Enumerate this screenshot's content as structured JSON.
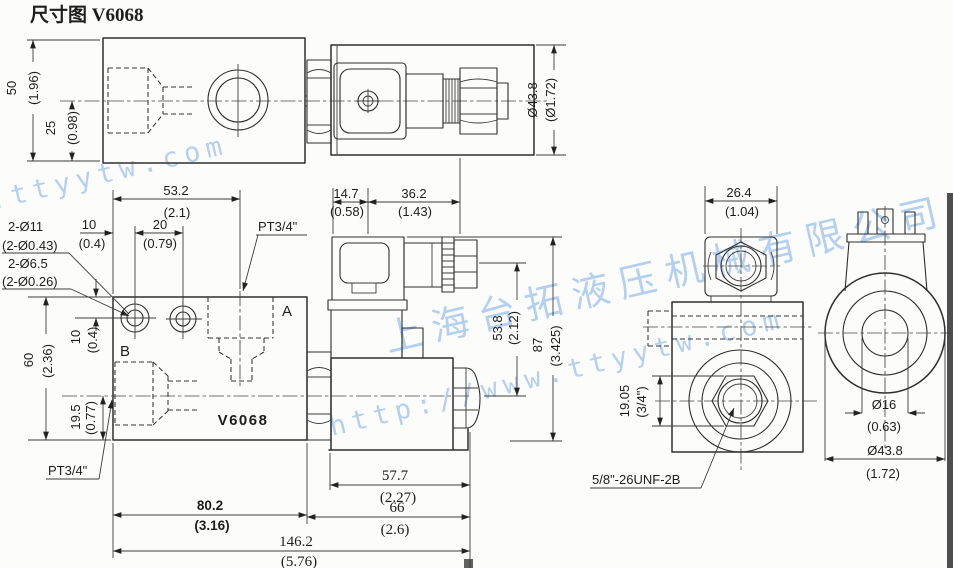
{
  "title": "尺寸图 V6068",
  "watermark": {
    "company": "上海台拓液压机械有限公司",
    "url": "http://www.ttyytw.com",
    "color": "#9fc4ee"
  },
  "labels": {
    "port_a": "A",
    "port_b": "B",
    "model": "V6068",
    "port_thread_top": "PT3/4\"",
    "port_thread_bottom": "PT3/4\"",
    "mount_holes_outer_mm": "2-Ø11",
    "mount_holes_outer_in": "(2-Ø0.43)",
    "mount_holes_inner_mm": "2-Ø6.5",
    "mount_holes_inner_in": "(2-Ø0.26)",
    "cartridge_thread": "5/8\"-26UNF-2B"
  },
  "dims": {
    "h50": {
      "mm": "50",
      "in": "(1.96)"
    },
    "h25": {
      "mm": "25",
      "in": "(0.98)"
    },
    "coil_od_top": {
      "mm": "Ø43.8",
      "in": "(Ø1.72)"
    },
    "w53_2": {
      "mm": "53.2",
      "in": "(2.1)"
    },
    "w10": {
      "mm": "10",
      "in": "(0.4)"
    },
    "w20": {
      "mm": "20",
      "in": "(0.79)"
    },
    "v10": {
      "mm": "10",
      "in": "(0.4)"
    },
    "v60": {
      "mm": "60",
      "in": "(2.36)"
    },
    "v19_5": {
      "mm": "19.5",
      "in": "(0.77)"
    },
    "w14_7": {
      "mm": "14.7",
      "in": "(0.58)"
    },
    "w36_2": {
      "mm": "36.2",
      "in": "(1.43)"
    },
    "v53_8": {
      "mm": "53.8",
      "in": "(2.12)"
    },
    "v87": {
      "mm": "87",
      "in": "(3.425)"
    },
    "w57_7": {
      "mm": "57.7",
      "in": "(2.27)"
    },
    "w66": {
      "mm": "66",
      "in": "(2.6)"
    },
    "w80_2": {
      "mm": "80.2",
      "in": "(3.16)"
    },
    "w146_2": {
      "mm": "146.2",
      "in": "(5.76)"
    },
    "w26_4": {
      "mm": "26.4",
      "in": "(1.04)"
    },
    "hex19_05": {
      "mm": "19.05",
      "in": "(3/4\")"
    },
    "d16": {
      "mm": "Ø16",
      "in": "(0.63)"
    },
    "coil_od_end": {
      "mm": "Ø43.8",
      "in": "(1.72)"
    }
  }
}
